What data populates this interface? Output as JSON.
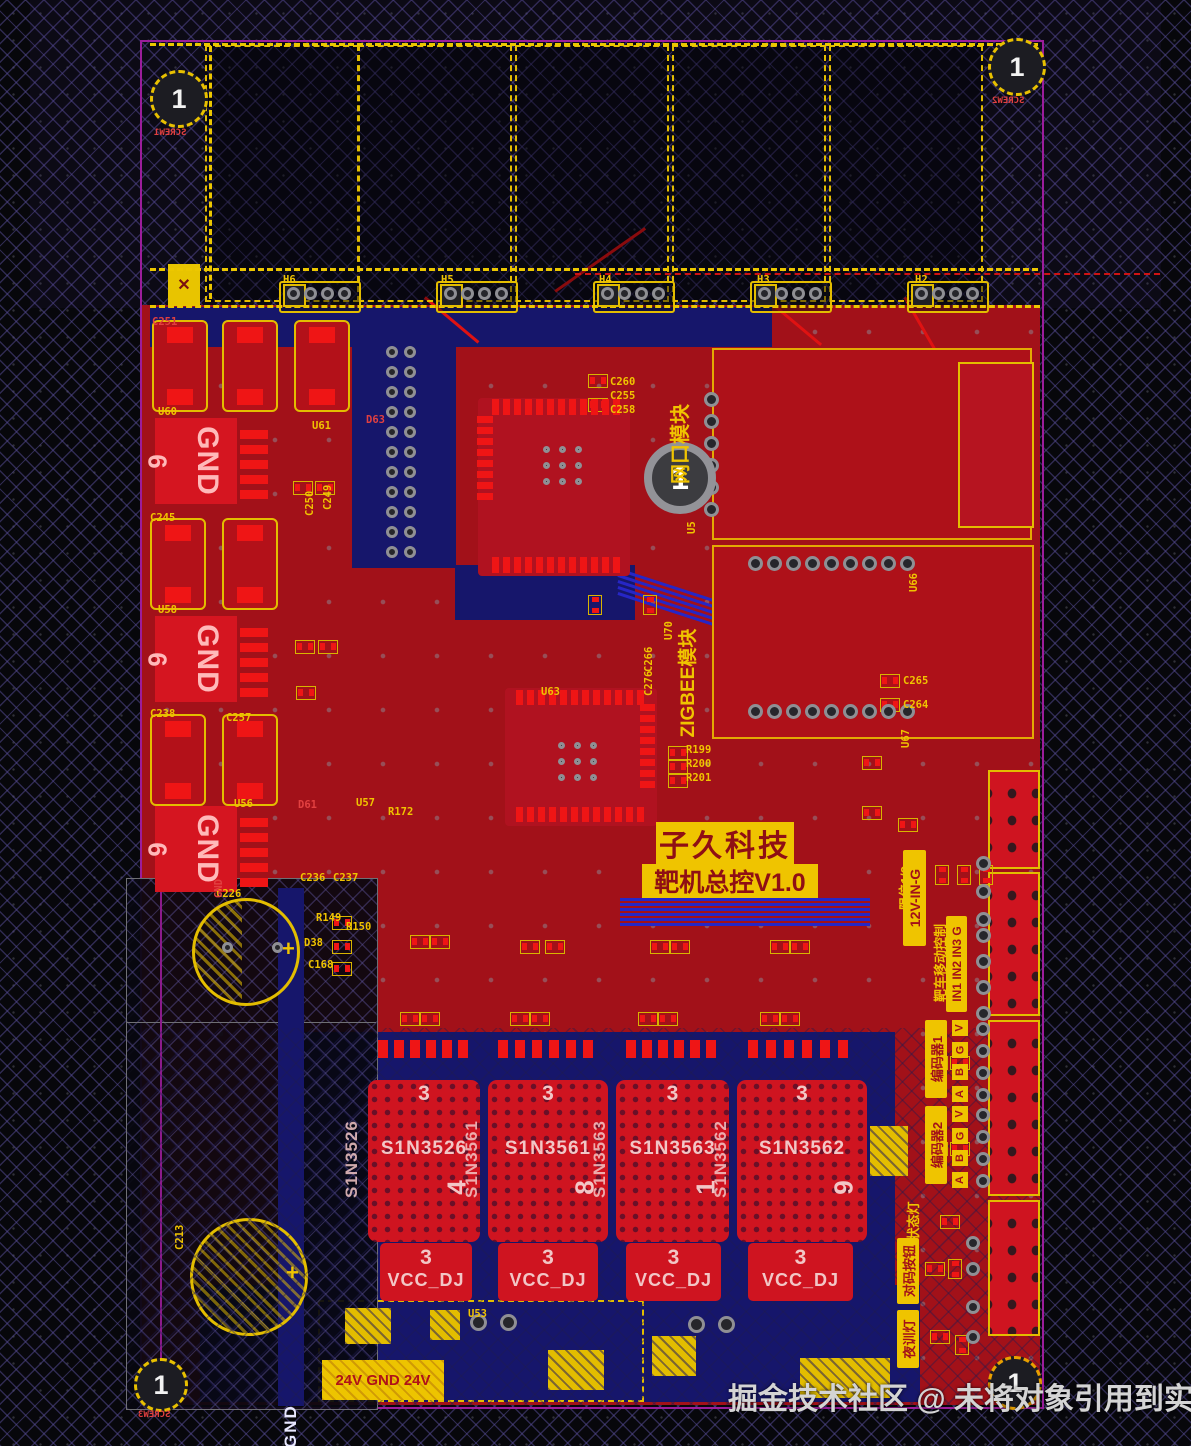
{
  "watermark": {
    "text": "掘金技术社区 @ 未将对象引用到实例"
  },
  "title_block": {
    "line1": "子久科技",
    "line2": "靶机总控V1.0"
  },
  "mount_hole": {
    "num": "1"
  },
  "bottom": {
    "power_label": "24V GND 24V",
    "gnd_net": "GND"
  },
  "colors": {
    "board": "#a21119",
    "pad": "#ef1515",
    "silk": "#f0c400",
    "trace": "#2626c6",
    "pour": "#16166b",
    "outline": "#9b1d9b",
    "net_text": "#f2c6c6"
  },
  "screws": [
    {
      "num": "1",
      "label": "SCREW1"
    },
    {
      "num": "1",
      "label": "SCREW2"
    },
    {
      "num": "1",
      "label": "SCREW3"
    },
    {
      "num": "1",
      "label": "SCREW4"
    }
  ],
  "gnd_blocks": [
    {
      "net": "GND",
      "pin": "6",
      "x": 155,
      "y": 418
    },
    {
      "net": "GND",
      "pin": "6",
      "x": 155,
      "y": 616
    },
    {
      "net": "GND",
      "pin": "6",
      "x": 155,
      "y": 806
    }
  ],
  "power_blocks": [
    {
      "net": "S1N3526",
      "digit": "4",
      "top_num": "3",
      "tab_num": "3",
      "tab_net": "VCC_DJ",
      "x": 368,
      "w": 112,
      "tab_x": 380,
      "tab_w": 92
    },
    {
      "net": "S1N3561",
      "digit": "8",
      "top_num": "3",
      "tab_num": "3",
      "tab_net": "VCC_DJ",
      "x": 488,
      "w": 120,
      "tab_x": 498,
      "tab_w": 100
    },
    {
      "net": "S1N3563",
      "digit": "1",
      "top_num": "3",
      "tab_num": "3",
      "tab_net": "VCC_DJ",
      "x": 616,
      "w": 113,
      "tab_x": 626,
      "tab_w": 95
    },
    {
      "net": "S1N3562",
      "digit": "9",
      "top_num": "3",
      "tab_num": "3",
      "tab_net": "VCC_DJ",
      "x": 737,
      "w": 130,
      "tab_x": 748,
      "tab_w": 105
    }
  ],
  "vlabels": [
    {
      "t": "网口模块",
      "n": "ethernet-module-label",
      "x": 664,
      "y": 368,
      "h": 152,
      "fs": 20,
      "k": "text"
    },
    {
      "t": "ZIGBEE模块",
      "n": "zigbee-module-label",
      "x": 672,
      "y": 588,
      "h": 190,
      "fs": 19,
      "k": "text"
    },
    {
      "t": "限位1/2",
      "n": "limit-switch-label",
      "x": 893,
      "y": 852,
      "h": 72,
      "fs": 13,
      "k": "text"
    },
    {
      "t": "12V-IN-G",
      "n": "power-in-label",
      "x": 903,
      "y": 850,
      "h": 96,
      "fs": 14,
      "k": "block"
    },
    {
      "t": "靶车移动控制",
      "n": "target-car-control-label",
      "x": 928,
      "y": 916,
      "h": 94,
      "fs": 13,
      "k": "text"
    },
    {
      "t": "IN1 IN2 IN3 G",
      "n": "input-pins-label",
      "x": 946,
      "y": 916,
      "h": 96,
      "fs": 12,
      "k": "block"
    },
    {
      "t": "编码器1",
      "n": "encoder1-label",
      "x": 925,
      "y": 1020,
      "h": 78,
      "fs": 13,
      "k": "block"
    },
    {
      "t": "编码器2",
      "n": "encoder2-label",
      "x": 925,
      "y": 1106,
      "h": 78,
      "fs": 13,
      "k": "block"
    },
    {
      "t": "状态灯",
      "n": "status-led-label",
      "x": 901,
      "y": 1192,
      "h": 58,
      "fs": 13,
      "k": "text"
    },
    {
      "t": "对码按钮",
      "n": "pairing-button-label",
      "x": 897,
      "y": 1238,
      "h": 66,
      "fs": 13,
      "k": "block"
    },
    {
      "t": "夜训灯",
      "n": "night-training-light-label",
      "x": 897,
      "y": 1310,
      "h": 58,
      "fs": 13,
      "k": "block"
    }
  ],
  "pin_letters": [
    {
      "t": "V",
      "x": 952,
      "y": 1020
    },
    {
      "t": "G",
      "x": 952,
      "y": 1042
    },
    {
      "t": "B",
      "x": 952,
      "y": 1064
    },
    {
      "t": "A",
      "x": 952,
      "y": 1086
    },
    {
      "t": "V",
      "x": 952,
      "y": 1106
    },
    {
      "t": "G",
      "x": 952,
      "y": 1128
    },
    {
      "t": "B",
      "x": 952,
      "y": 1150
    },
    {
      "t": "A",
      "x": 952,
      "y": 1172
    }
  ],
  "silk_labels": [
    {
      "t": "C251",
      "x": 152,
      "y": 316,
      "c": "red"
    },
    {
      "t": "C245",
      "x": 150,
      "y": 512
    },
    {
      "t": "C238",
      "x": 150,
      "y": 708
    },
    {
      "t": "C257",
      "x": 226,
      "y": 712
    },
    {
      "t": "C236",
      "x": 300,
      "y": 872
    },
    {
      "t": "C237",
      "x": 333,
      "y": 872
    },
    {
      "t": "C226",
      "x": 216,
      "y": 888
    },
    {
      "t": "C213",
      "x": 174,
      "y": 1250,
      "r": -90
    },
    {
      "t": "U60",
      "x": 158,
      "y": 406
    },
    {
      "t": "U58",
      "x": 158,
      "y": 604
    },
    {
      "t": "U56",
      "x": 234,
      "y": 798
    },
    {
      "t": "D63",
      "x": 366,
      "y": 414,
      "c": "red"
    },
    {
      "t": "U61",
      "x": 312,
      "y": 420
    },
    {
      "t": "D61",
      "x": 298,
      "y": 799,
      "c": "red"
    },
    {
      "t": "U57",
      "x": 356,
      "y": 797
    },
    {
      "t": "R172",
      "x": 388,
      "y": 806
    },
    {
      "t": "U63",
      "x": 541,
      "y": 686
    },
    {
      "t": "C260",
      "x": 610,
      "y": 376
    },
    {
      "t": "C255",
      "x": 610,
      "y": 390
    },
    {
      "t": "C258",
      "x": 610,
      "y": 404
    },
    {
      "t": "C265",
      "x": 903,
      "y": 675
    },
    {
      "t": "C264",
      "x": 903,
      "y": 699
    },
    {
      "t": "U70",
      "x": 663,
      "y": 640,
      "r": -90
    },
    {
      "t": "U66",
      "x": 908,
      "y": 592,
      "r": -90
    },
    {
      "t": "U67",
      "x": 900,
      "y": 748,
      "r": -90
    },
    {
      "t": "H6",
      "x": 283,
      "y": 274
    },
    {
      "t": "H5",
      "x": 441,
      "y": 274
    },
    {
      "t": "H4",
      "x": 599,
      "y": 274
    },
    {
      "t": "H3",
      "x": 757,
      "y": 274
    },
    {
      "t": "H2",
      "x": 915,
      "y": 274
    },
    {
      "t": "R199",
      "x": 686,
      "y": 744
    },
    {
      "t": "R200",
      "x": 686,
      "y": 758
    },
    {
      "t": "R201",
      "x": 686,
      "y": 772
    },
    {
      "t": "R149",
      "x": 316,
      "y": 912
    },
    {
      "t": "R150",
      "x": 346,
      "y": 921
    },
    {
      "t": "D38",
      "x": 304,
      "y": 937
    },
    {
      "t": "C168",
      "x": 308,
      "y": 959
    },
    {
      "t": "U5",
      "x": 686,
      "y": 534,
      "r": -90
    },
    {
      "t": "U53",
      "x": 468,
      "y": 1308
    },
    {
      "t": "C266",
      "x": 643,
      "y": 672,
      "r": -90
    },
    {
      "t": "C276",
      "x": 643,
      "y": 696,
      "r": -90
    },
    {
      "t": "C249",
      "x": 322,
      "y": 510,
      "r": -90
    },
    {
      "t": "C250",
      "x": 304,
      "y": 516,
      "r": -90
    },
    {
      "t": "GND",
      "x": 213,
      "y": 898,
      "r": -90,
      "c": "red"
    }
  ],
  "antennas": [
    {
      "x": 205,
      "y": 45,
      "w": 150,
      "h": 253
    },
    {
      "x": 358,
      "y": 45,
      "w": 150,
      "h": 253
    },
    {
      "x": 515,
      "y": 45,
      "w": 150,
      "h": 253
    },
    {
      "x": 672,
      "y": 45,
      "w": 150,
      "h": 253
    },
    {
      "x": 829,
      "y": 45,
      "w": 150,
      "h": 253
    }
  ],
  "hgroups": [
    287,
    444,
    601,
    758,
    915
  ],
  "navy_rects": [
    {
      "x": 150,
      "y": 307,
      "w": 622,
      "h": 40
    },
    {
      "x": 352,
      "y": 336,
      "w": 104,
      "h": 232
    },
    {
      "x": 455,
      "y": 565,
      "w": 180,
      "h": 55
    },
    {
      "x": 310,
      "y": 1032,
      "w": 585,
      "h": 273
    },
    {
      "x": 200,
      "y": 1285,
      "w": 720,
      "h": 117
    },
    {
      "x": 865,
      "y": 1040,
      "w": 30,
      "h": 260
    },
    {
      "x": 296,
      "y": 1032,
      "w": 18,
      "h": 270
    }
  ],
  "conn_rects": [
    {
      "x": 988,
      "y": 770,
      "w": 48,
      "h": 95
    },
    {
      "x": 988,
      "y": 872,
      "w": 48,
      "h": 140
    },
    {
      "x": 988,
      "y": 1020,
      "w": 48,
      "h": 172
    },
    {
      "x": 988,
      "y": 1200,
      "w": 48,
      "h": 132
    }
  ],
  "cap_outlines": [
    {
      "x": 152,
      "y": 320,
      "w": 52,
      "h": 88
    },
    {
      "x": 222,
      "y": 320,
      "w": 52,
      "h": 88
    },
    {
      "x": 294,
      "y": 320,
      "w": 52,
      "h": 88
    },
    {
      "x": 150,
      "y": 518,
      "w": 52,
      "h": 88
    },
    {
      "x": 222,
      "y": 518,
      "w": 52,
      "h": 88
    },
    {
      "x": 150,
      "y": 714,
      "w": 52,
      "h": 88
    },
    {
      "x": 222,
      "y": 714,
      "w": 52,
      "h": 88
    }
  ],
  "hatch_rects": [
    {
      "x": 345,
      "y": 1308,
      "w": 46,
      "h": 36
    },
    {
      "x": 548,
      "y": 1350,
      "w": 56,
      "h": 40
    },
    {
      "x": 652,
      "y": 1336,
      "w": 44,
      "h": 40
    },
    {
      "x": 800,
      "y": 1358,
      "w": 90,
      "h": 40
    },
    {
      "x": 870,
      "y": 1126,
      "w": 38,
      "h": 50
    },
    {
      "x": 430,
      "y": 1310,
      "w": 30,
      "h": 30
    }
  ],
  "pad_rows": [
    {
      "x": 287,
      "y": 287,
      "n": 4,
      "dx": 17,
      "dy": 0,
      "d": 13
    },
    {
      "x": 444,
      "y": 287,
      "n": 4,
      "dx": 17,
      "dy": 0,
      "d": 13
    },
    {
      "x": 601,
      "y": 287,
      "n": 4,
      "dx": 17,
      "dy": 0,
      "d": 13
    },
    {
      "x": 758,
      "y": 287,
      "n": 4,
      "dx": 17,
      "dy": 0,
      "d": 13
    },
    {
      "x": 915,
      "y": 287,
      "n": 4,
      "dx": 17,
      "dy": 0,
      "d": 13
    },
    {
      "x": 704,
      "y": 392,
      "n": 6,
      "dx": 0,
      "dy": 22,
      "d": 15
    },
    {
      "x": 748,
      "y": 556,
      "n": 9,
      "dx": 19,
      "dy": 0,
      "d": 15
    },
    {
      "x": 748,
      "y": 704,
      "n": 9,
      "dx": 19,
      "dy": 0,
      "d": 15
    },
    {
      "x": 386,
      "y": 346,
      "n": 11,
      "dx": 0,
      "dy": 20,
      "d": 12
    },
    {
      "x": 404,
      "y": 346,
      "n": 11,
      "dx": 0,
      "dy": 20,
      "d": 12
    },
    {
      "x": 976,
      "y": 856,
      "n": 3,
      "dx": 0,
      "dy": 28,
      "d": 15
    },
    {
      "x": 976,
      "y": 928,
      "n": 4,
      "dx": 0,
      "dy": 26,
      "d": 15
    },
    {
      "x": 976,
      "y": 1022,
      "n": 4,
      "dx": 0,
      "dy": 22,
      "d": 14
    },
    {
      "x": 976,
      "y": 1108,
      "n": 4,
      "dx": 0,
      "dy": 22,
      "d": 14
    },
    {
      "x": 966,
      "y": 1236,
      "n": 2,
      "dx": 0,
      "dy": 26,
      "d": 14
    },
    {
      "x": 966,
      "y": 1300,
      "n": 2,
      "dx": 0,
      "dy": 30,
      "d": 14
    },
    {
      "x": 543,
      "y": 446,
      "n": 3,
      "dx": 16,
      "dy": 0,
      "d": 7
    },
    {
      "x": 543,
      "y": 462,
      "n": 3,
      "dx": 16,
      "dy": 0,
      "d": 7
    },
    {
      "x": 543,
      "y": 478,
      "n": 3,
      "dx": 16,
      "dy": 0,
      "d": 7
    },
    {
      "x": 558,
      "y": 742,
      "n": 3,
      "dx": 16,
      "dy": 0,
      "d": 7
    },
    {
      "x": 558,
      "y": 758,
      "n": 3,
      "dx": 16,
      "dy": 0,
      "d": 7
    },
    {
      "x": 558,
      "y": 774,
      "n": 3,
      "dx": 16,
      "dy": 0,
      "d": 7
    },
    {
      "x": 222,
      "y": 942,
      "n": 2,
      "dx": 50,
      "dy": 0,
      "d": 11
    },
    {
      "x": 470,
      "y": 1314,
      "n": 2,
      "dx": 30,
      "dy": 0,
      "d": 17
    },
    {
      "x": 688,
      "y": 1316,
      "n": 2,
      "dx": 30,
      "dy": 0,
      "d": 17
    }
  ],
  "smd_rows": [
    {
      "x": 492,
      "y": 399,
      "n": 12,
      "dx": 11,
      "dy": 0,
      "w": 7,
      "h": 16
    },
    {
      "x": 492,
      "y": 557,
      "n": 12,
      "dx": 11,
      "dy": 0,
      "w": 7,
      "h": 16
    },
    {
      "x": 477,
      "y": 416,
      "n": 8,
      "dx": 0,
      "dy": 11,
      "w": 16,
      "h": 7
    },
    {
      "x": 516,
      "y": 690,
      "n": 12,
      "dx": 11,
      "dy": 0,
      "w": 7,
      "h": 15
    },
    {
      "x": 516,
      "y": 807,
      "n": 12,
      "dx": 11,
      "dy": 0,
      "w": 7,
      "h": 15
    },
    {
      "x": 640,
      "y": 704,
      "n": 8,
      "dx": 0,
      "dy": 11,
      "w": 15,
      "h": 7
    },
    {
      "x": 240,
      "y": 430,
      "n": 5,
      "dx": 0,
      "dy": 15,
      "w": 28,
      "h": 9
    },
    {
      "x": 240,
      "y": 628,
      "n": 5,
      "dx": 0,
      "dy": 15,
      "w": 28,
      "h": 9
    },
    {
      "x": 240,
      "y": 818,
      "n": 5,
      "dx": 0,
      "dy": 15,
      "w": 28,
      "h": 9
    },
    {
      "x": 378,
      "y": 1040,
      "n": 6,
      "dx": 16,
      "dy": 0,
      "w": 10,
      "h": 18
    },
    {
      "x": 498,
      "y": 1040,
      "n": 6,
      "dx": 17,
      "dy": 0,
      "w": 10,
      "h": 18
    },
    {
      "x": 626,
      "y": 1040,
      "n": 6,
      "dx": 16,
      "dy": 0,
      "w": 10,
      "h": 18
    },
    {
      "x": 748,
      "y": 1040,
      "n": 6,
      "dx": 18,
      "dy": 0,
      "w": 10,
      "h": 18
    }
  ],
  "chip2": [
    {
      "x": 293,
      "y": 481,
      "r": 0
    },
    {
      "x": 315,
      "y": 481,
      "r": 0
    },
    {
      "x": 295,
      "y": 640,
      "r": 0
    },
    {
      "x": 318,
      "y": 640,
      "r": 0
    },
    {
      "x": 296,
      "y": 686,
      "r": 0
    },
    {
      "x": 585,
      "y": 598,
      "r": 90
    },
    {
      "x": 640,
      "y": 598,
      "r": 90
    },
    {
      "x": 862,
      "y": 756,
      "r": 0
    },
    {
      "x": 862,
      "y": 806,
      "r": 0
    },
    {
      "x": 898,
      "y": 818,
      "r": 0
    },
    {
      "x": 932,
      "y": 868,
      "r": 90
    },
    {
      "x": 954,
      "y": 868,
      "r": 90
    },
    {
      "x": 976,
      "y": 868,
      "r": 90
    },
    {
      "x": 928,
      "y": 1056,
      "r": 0
    },
    {
      "x": 950,
      "y": 1056,
      "r": 0
    },
    {
      "x": 928,
      "y": 1142,
      "r": 0
    },
    {
      "x": 950,
      "y": 1142,
      "r": 0
    },
    {
      "x": 940,
      "y": 1215,
      "r": 0
    },
    {
      "x": 925,
      "y": 1262,
      "r": 0
    },
    {
      "x": 945,
      "y": 1262,
      "r": 90
    },
    {
      "x": 930,
      "y": 1330,
      "r": 0
    },
    {
      "x": 952,
      "y": 1338,
      "r": 90
    },
    {
      "x": 588,
      "y": 374,
      "r": 0
    },
    {
      "x": 588,
      "y": 398,
      "r": 0
    },
    {
      "x": 880,
      "y": 674,
      "r": 0
    },
    {
      "x": 880,
      "y": 698,
      "r": 0
    },
    {
      "x": 668,
      "y": 746,
      "r": 0
    },
    {
      "x": 668,
      "y": 760,
      "r": 0
    },
    {
      "x": 668,
      "y": 774,
      "r": 0
    },
    {
      "x": 332,
      "y": 916,
      "r": 0
    },
    {
      "x": 332,
      "y": 940,
      "r": 0
    },
    {
      "x": 332,
      "y": 962,
      "r": 0
    },
    {
      "x": 400,
      "y": 1012,
      "r": 0
    },
    {
      "x": 420,
      "y": 1012,
      "r": 0
    },
    {
      "x": 510,
      "y": 1012,
      "r": 0
    },
    {
      "x": 530,
      "y": 1012,
      "r": 0
    },
    {
      "x": 638,
      "y": 1012,
      "r": 0
    },
    {
      "x": 658,
      "y": 1012,
      "r": 0
    },
    {
      "x": 760,
      "y": 1012,
      "r": 0
    },
    {
      "x": 780,
      "y": 1012,
      "r": 0
    },
    {
      "x": 410,
      "y": 935,
      "r": 0
    },
    {
      "x": 430,
      "y": 935,
      "r": 0
    },
    {
      "x": 520,
      "y": 940,
      "r": 0
    },
    {
      "x": 545,
      "y": 940,
      "r": 0
    },
    {
      "x": 650,
      "y": 940,
      "r": 0
    },
    {
      "x": 670,
      "y": 940,
      "r": 0
    },
    {
      "x": 770,
      "y": 940,
      "r": 0
    },
    {
      "x": 790,
      "y": 940,
      "r": 0
    }
  ],
  "traces": [
    {
      "x": 618,
      "y": 568,
      "l": 165,
      "a": 18
    },
    {
      "x": 618,
      "y": 574,
      "l": 165,
      "a": 18
    },
    {
      "x": 618,
      "y": 580,
      "l": 165,
      "a": 18
    },
    {
      "x": 618,
      "y": 586,
      "l": 165,
      "a": 18
    },
    {
      "x": 618,
      "y": 592,
      "l": 165,
      "a": 18
    },
    {
      "x": 620,
      "y": 898,
      "l": 250,
      "a": 0
    },
    {
      "x": 620,
      "y": 903,
      "l": 250,
      "a": 0
    },
    {
      "x": 620,
      "y": 908,
      "l": 250,
      "a": 0
    },
    {
      "x": 620,
      "y": 913,
      "l": 250,
      "a": 0
    },
    {
      "x": 620,
      "y": 918,
      "l": 250,
      "a": 0
    },
    {
      "x": 620,
      "y": 923,
      "l": 250,
      "a": 0
    },
    {
      "x": 742,
      "y": 652,
      "l": 225,
      "a": -18
    },
    {
      "x": 425,
      "y": 296,
      "l": 70,
      "a": 40,
      "c": "red"
    },
    {
      "x": 555,
      "y": 290,
      "l": 110,
      "a": -35,
      "c": "red"
    },
    {
      "x": 905,
      "y": 296,
      "l": 60,
      "a": 60,
      "c": "red"
    },
    {
      "x": 760,
      "y": 292,
      "l": 80,
      "a": 40,
      "c": "red"
    }
  ],
  "dash_lines": [
    {
      "x": 150,
      "y": 43,
      "l": 888,
      "c": "y"
    },
    {
      "x": 150,
      "y": 268,
      "l": 888,
      "c": "y"
    },
    {
      "x": 575,
      "y": 273,
      "l": 585,
      "c": "r"
    },
    {
      "x": 150,
      "y": 305,
      "l": 890,
      "c": "y"
    },
    {
      "x": 212,
      "y": 46,
      "l": 253,
      "c": "y",
      "v": true
    }
  ]
}
